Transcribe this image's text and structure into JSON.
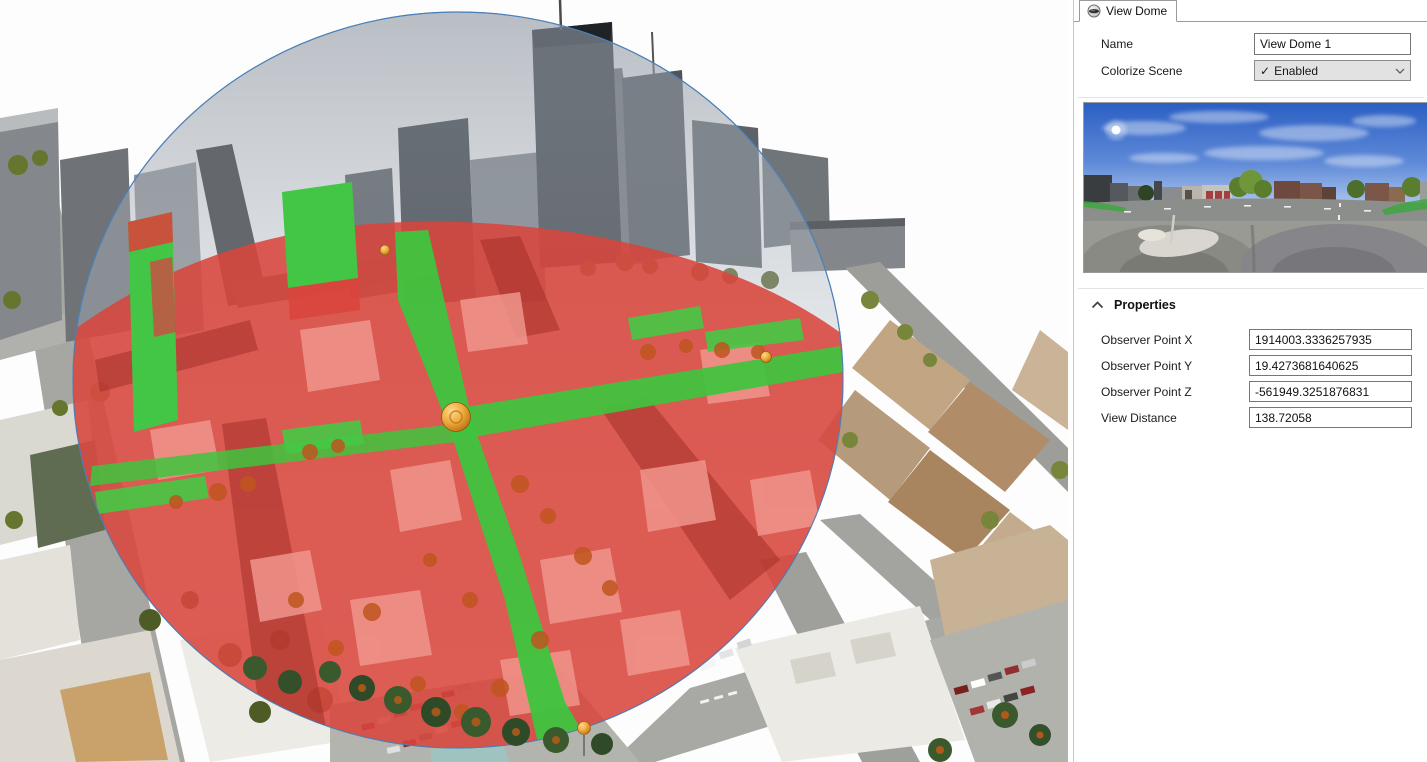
{
  "panel": {
    "tab": {
      "label": "View Dome",
      "icon": "view-dome-icon"
    },
    "name_field": {
      "label": "Name",
      "value": "View Dome 1"
    },
    "colorize_field": {
      "label": "Colorize Scene",
      "value": "Enabled",
      "check": "✓"
    },
    "preview": {
      "description": "360-degree panorama preview of scene from observer point"
    },
    "properties": {
      "header": "Properties",
      "rows": [
        {
          "label": "Observer Point X",
          "value": "1914003.3336257935"
        },
        {
          "label": "Observer Point Y",
          "value": "19.4273681640625"
        },
        {
          "label": "Observer Point Z",
          "value": "-561949.3251876831"
        },
        {
          "label": "View Distance",
          "value": "138.72058"
        }
      ]
    }
  },
  "scene": {
    "colors": {
      "visible_overlay_green": "#3ec43e",
      "obstructed_overlay_red": "#d8453c",
      "dome_outline_blue": "#4d80b8",
      "observer_sphere_orange": "#e8a33d",
      "sky_tint_gray": "#9aa2ac"
    }
  }
}
